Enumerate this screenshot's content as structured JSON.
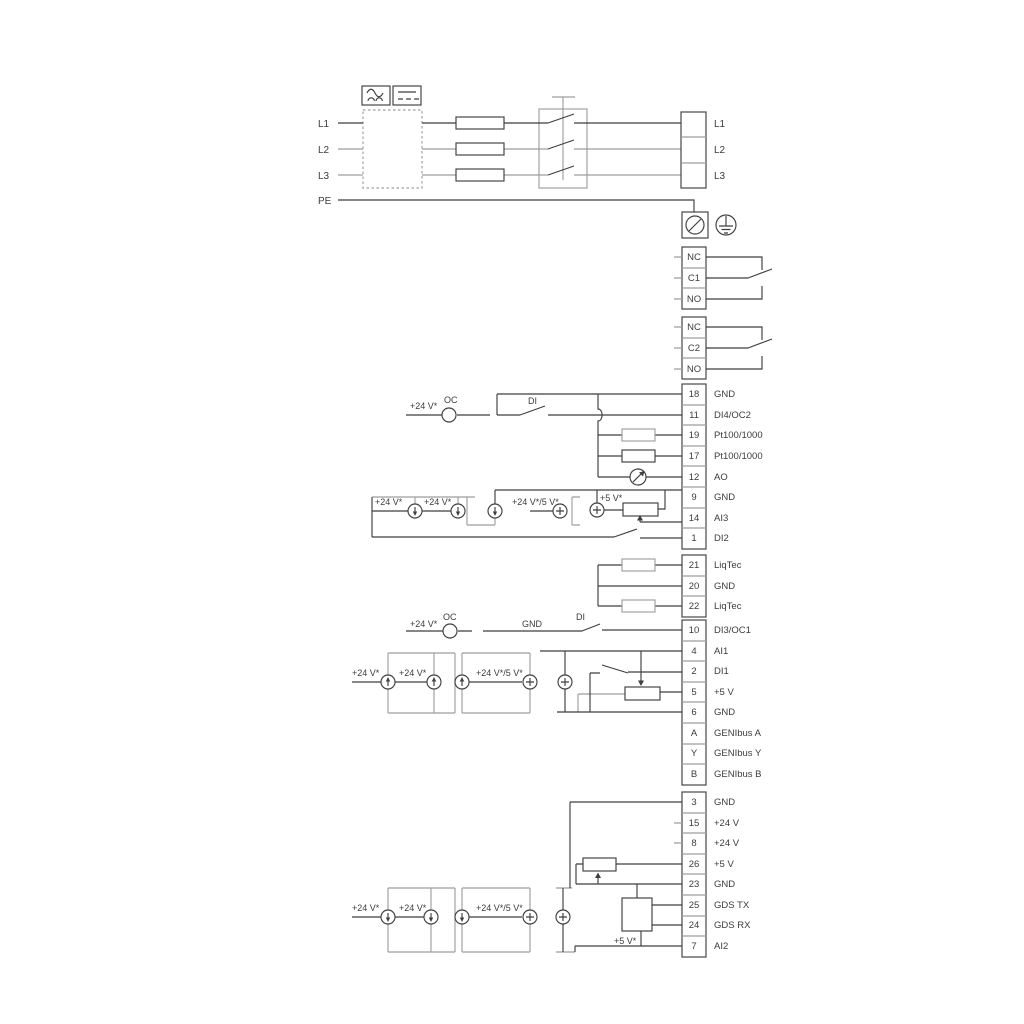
{
  "power": {
    "in": {
      "l1": "L1",
      "l2": "L2",
      "l3": "L3",
      "pe": "PE"
    },
    "out": {
      "l1": "L1",
      "l2": "L2",
      "l3": "L3"
    }
  },
  "relays": {
    "r1": {
      "nc": "NC",
      "c": "C1",
      "no": "NO"
    },
    "r2": {
      "nc": "NC",
      "c": "C2",
      "no": "NO"
    }
  },
  "blocks": {
    "a": [
      {
        "n": "18",
        "t": "GND"
      },
      {
        "n": "11",
        "t": "DI4/OC2"
      },
      {
        "n": "19",
        "t": "Pt100/1000"
      },
      {
        "n": "17",
        "t": "Pt100/1000"
      },
      {
        "n": "12",
        "t": "AO"
      },
      {
        "n": "9",
        "t": "GND"
      },
      {
        "n": "14",
        "t": "AI3"
      },
      {
        "n": "1",
        "t": "DI2"
      }
    ],
    "b": [
      {
        "n": "21",
        "t": "LiqTec"
      },
      {
        "n": "20",
        "t": "GND"
      },
      {
        "n": "22",
        "t": "LiqTec"
      }
    ],
    "c": [
      {
        "n": "10",
        "t": "DI3/OC1"
      },
      {
        "n": "4",
        "t": "AI1"
      },
      {
        "n": "2",
        "t": "DI1"
      },
      {
        "n": "5",
        "t": "+5 V"
      },
      {
        "n": "6",
        "t": "GND"
      },
      {
        "n": "A",
        "t": "GENIbus A"
      },
      {
        "n": "Y",
        "t": "GENIbus Y"
      },
      {
        "n": "B",
        "t": "GENIbus B"
      }
    ],
    "d": [
      {
        "n": "3",
        "t": "GND"
      },
      {
        "n": "15",
        "t": "+24 V"
      },
      {
        "n": "8",
        "t": "+24 V"
      },
      {
        "n": "26",
        "t": "+5 V"
      },
      {
        "n": "23",
        "t": "GND"
      },
      {
        "n": "25",
        "t": "GDS TX"
      },
      {
        "n": "24",
        "t": "GDS RX"
      },
      {
        "n": "7",
        "t": "AI2"
      }
    ]
  },
  "ann": {
    "plus24": "+24 V*",
    "plus24_5": "+24 V*/5 V*",
    "plus5": "+5 V*",
    "oc": "OC",
    "di": "DI",
    "gnd": "GND"
  },
  "colors": {
    "wire_dark": "#3f3f3f",
    "wire_gray": "#9e9e9e",
    "text": "#3c3c3c",
    "background": "#ffffff"
  }
}
